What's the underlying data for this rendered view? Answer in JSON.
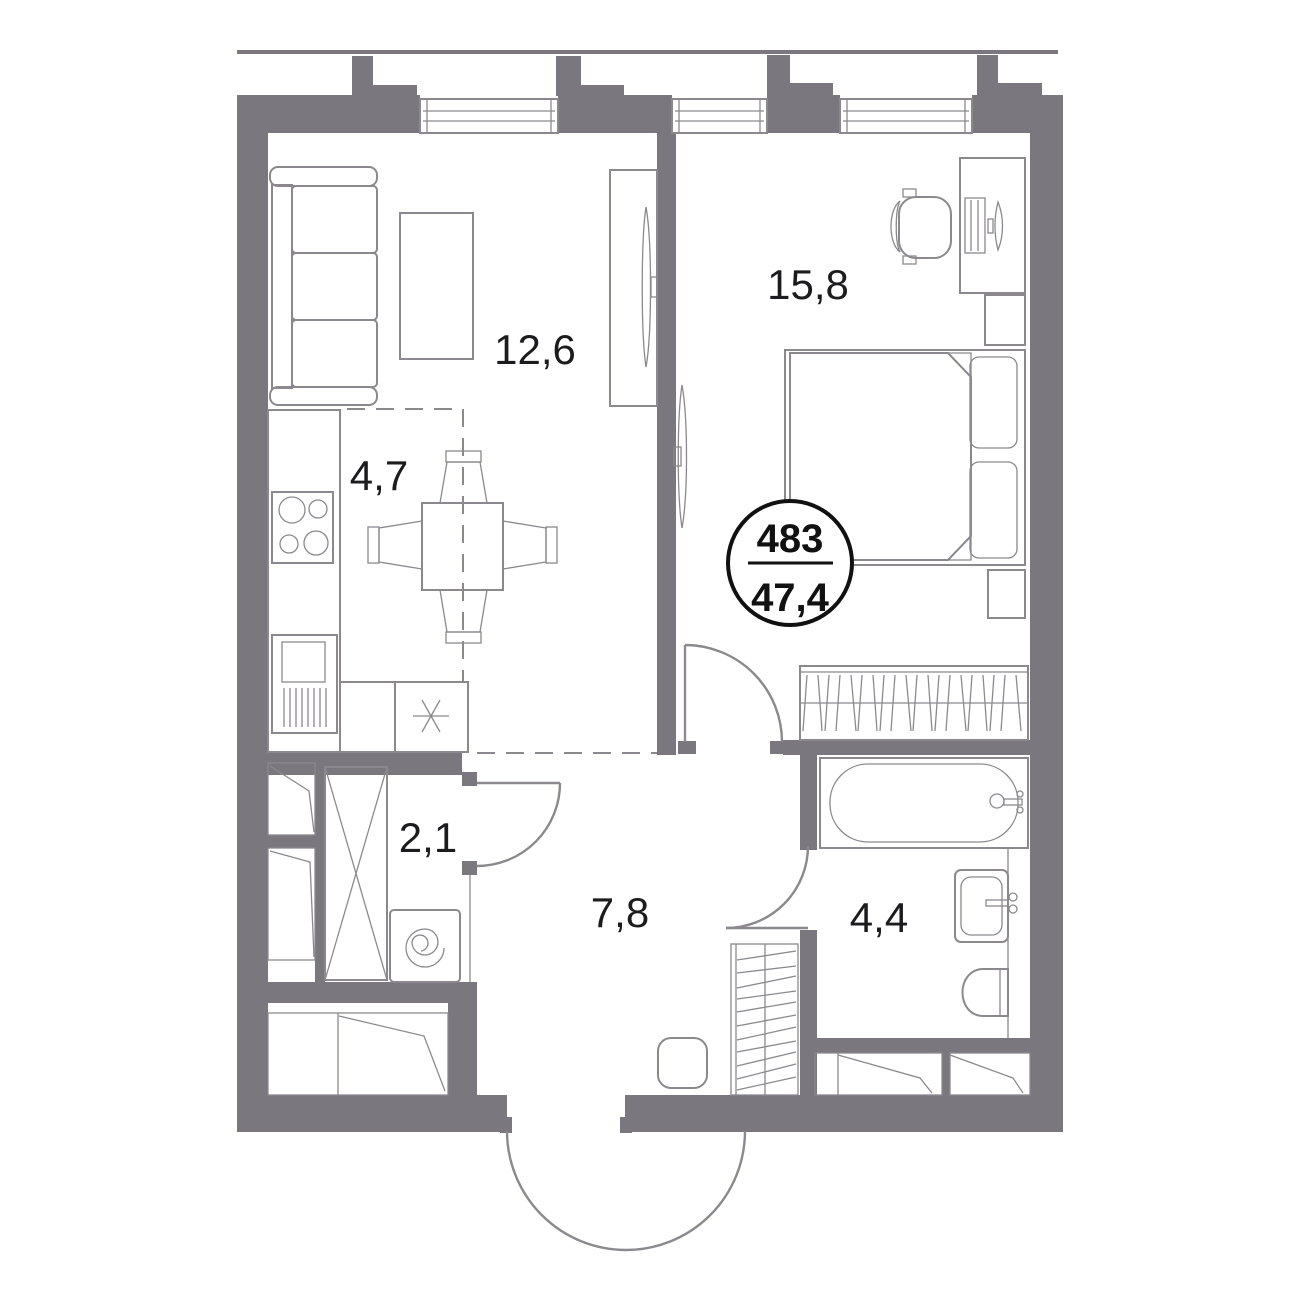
{
  "plan": {
    "badge": {
      "number": "483",
      "area": "47,4"
    },
    "rooms": {
      "living": {
        "area": "12,6"
      },
      "kitchen": {
        "area": "4,7"
      },
      "bedroom": {
        "area": "15,8"
      },
      "wardrobe": {
        "area": "2,1"
      },
      "hallway": {
        "area": "7,8"
      },
      "bathroom": {
        "area": "4,4"
      }
    },
    "colors": {
      "wall": "#7a777e",
      "line": "#8b898e",
      "text": "#1c1c1e",
      "badge": "#111111"
    }
  }
}
